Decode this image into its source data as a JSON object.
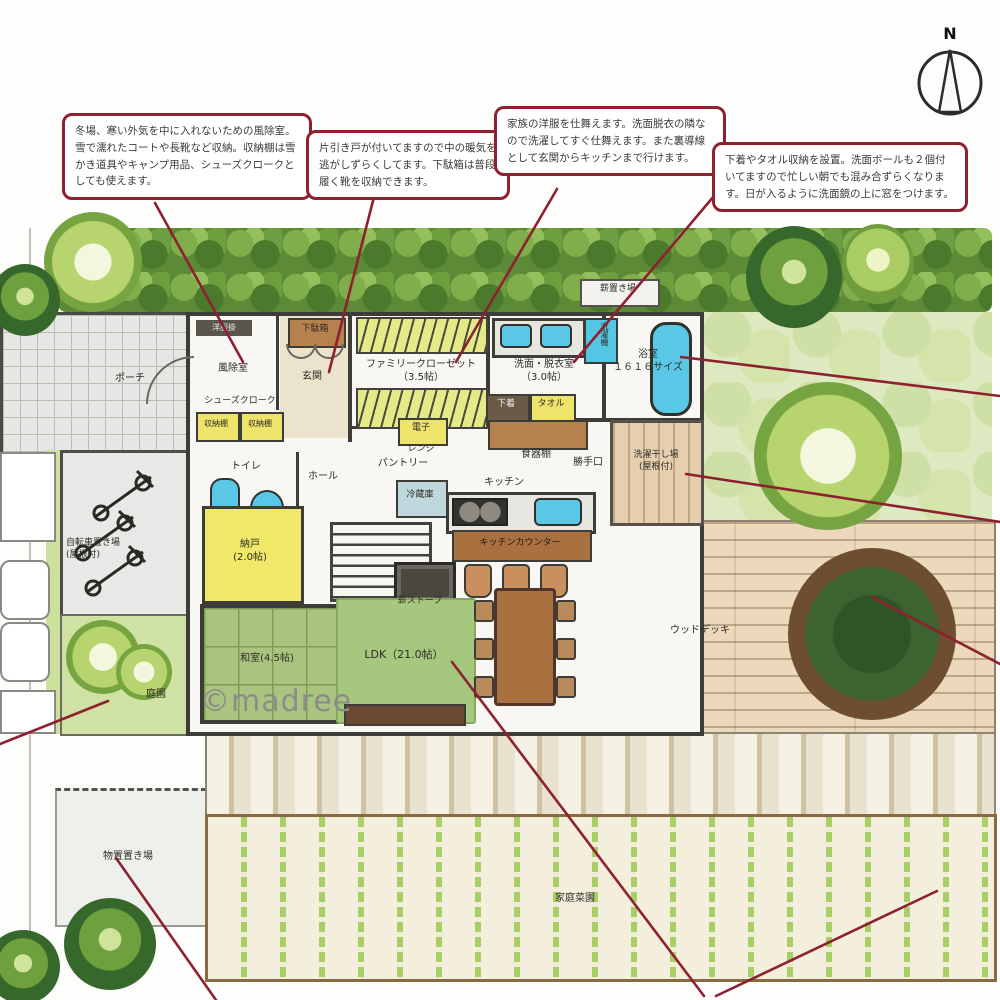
{
  "annotations": [
    {
      "id": "windbreak-note",
      "text": "冬場、寒い外気を中に入れないための風除室。雪で濡れたコートや長靴など収納。収納棚は雪かき道具やキャンプ用品、シューズクロークとしても使えます。"
    },
    {
      "id": "sliding-door-note",
      "text": "片引き戸が付いてますので中の暖気を逃がしずらくしてます。下駄箱は普段履く靴を収納できます。"
    },
    {
      "id": "family-closet-note",
      "text": "家族の洋服を仕舞えます。洗面脱衣の隣なので洗濯してすぐ仕舞えます。また裏導線として玄関からキッチンまで行けます。"
    },
    {
      "id": "washroom-note",
      "text": "下着やタオル収納を設置。洗面ボールも２個付いてますので忙しい朝でも混み合ずらくなります。日が入るように洗面鏡の上に窓をつけます。"
    }
  ],
  "compass": {
    "label": "N"
  },
  "watermark": "©madree",
  "plan": {
    "porch": "ポーチ",
    "clothes_rack": "洋服掛",
    "windbreak_room": "風除室",
    "shoes_closet": "シューズクローク",
    "storage_shelf_1": "収納棚",
    "storage_shelf_2": "収納棚",
    "shoe_cabinet": "下駄箱",
    "entrance": "玄関",
    "family_closet": "ファミリークローゼット\n（3.5帖）",
    "washroom": "洗面・脱衣室\n（3.0帖）",
    "washing_machine": "洗濯機",
    "bathroom": "浴室\n１６１６サイズ",
    "firewood_storage": "薪置き場",
    "underwear": "下着",
    "towel": "タオル",
    "microwave_top": "電子",
    "microwave_bottom": "レンジ",
    "cupboard": "食器棚",
    "pantry": "パントリー",
    "toilet": "トイレ",
    "hall": "ホール",
    "back_door": "勝手口",
    "laundry_deck": "洗濯干し場\n(屋根付)",
    "fridge": "冷蔵庫",
    "kitchen": "キッチン",
    "kitchen_counter": "キッチンカウンター",
    "storeroom": "納戸\n(2.0帖)",
    "wood_stove": "薪ストーブ",
    "tatami_room": "和室(4.5帖)",
    "ldk": "LDK（21.0帖）",
    "bicycle_parking": "自転車置き場\n(屋根付)",
    "garden": "庭園",
    "wood_deck": "ウッドデッキ",
    "storage_yard": "物置置き場",
    "vegetable_garden": "家庭菜園"
  },
  "colors": {
    "leader_red": "#8e2130",
    "tatami_green": "#aac47f",
    "deck_tan": "#ecd8ba",
    "fixture_blue": "#58c8e6",
    "hedge_green": "#5d8a36"
  }
}
